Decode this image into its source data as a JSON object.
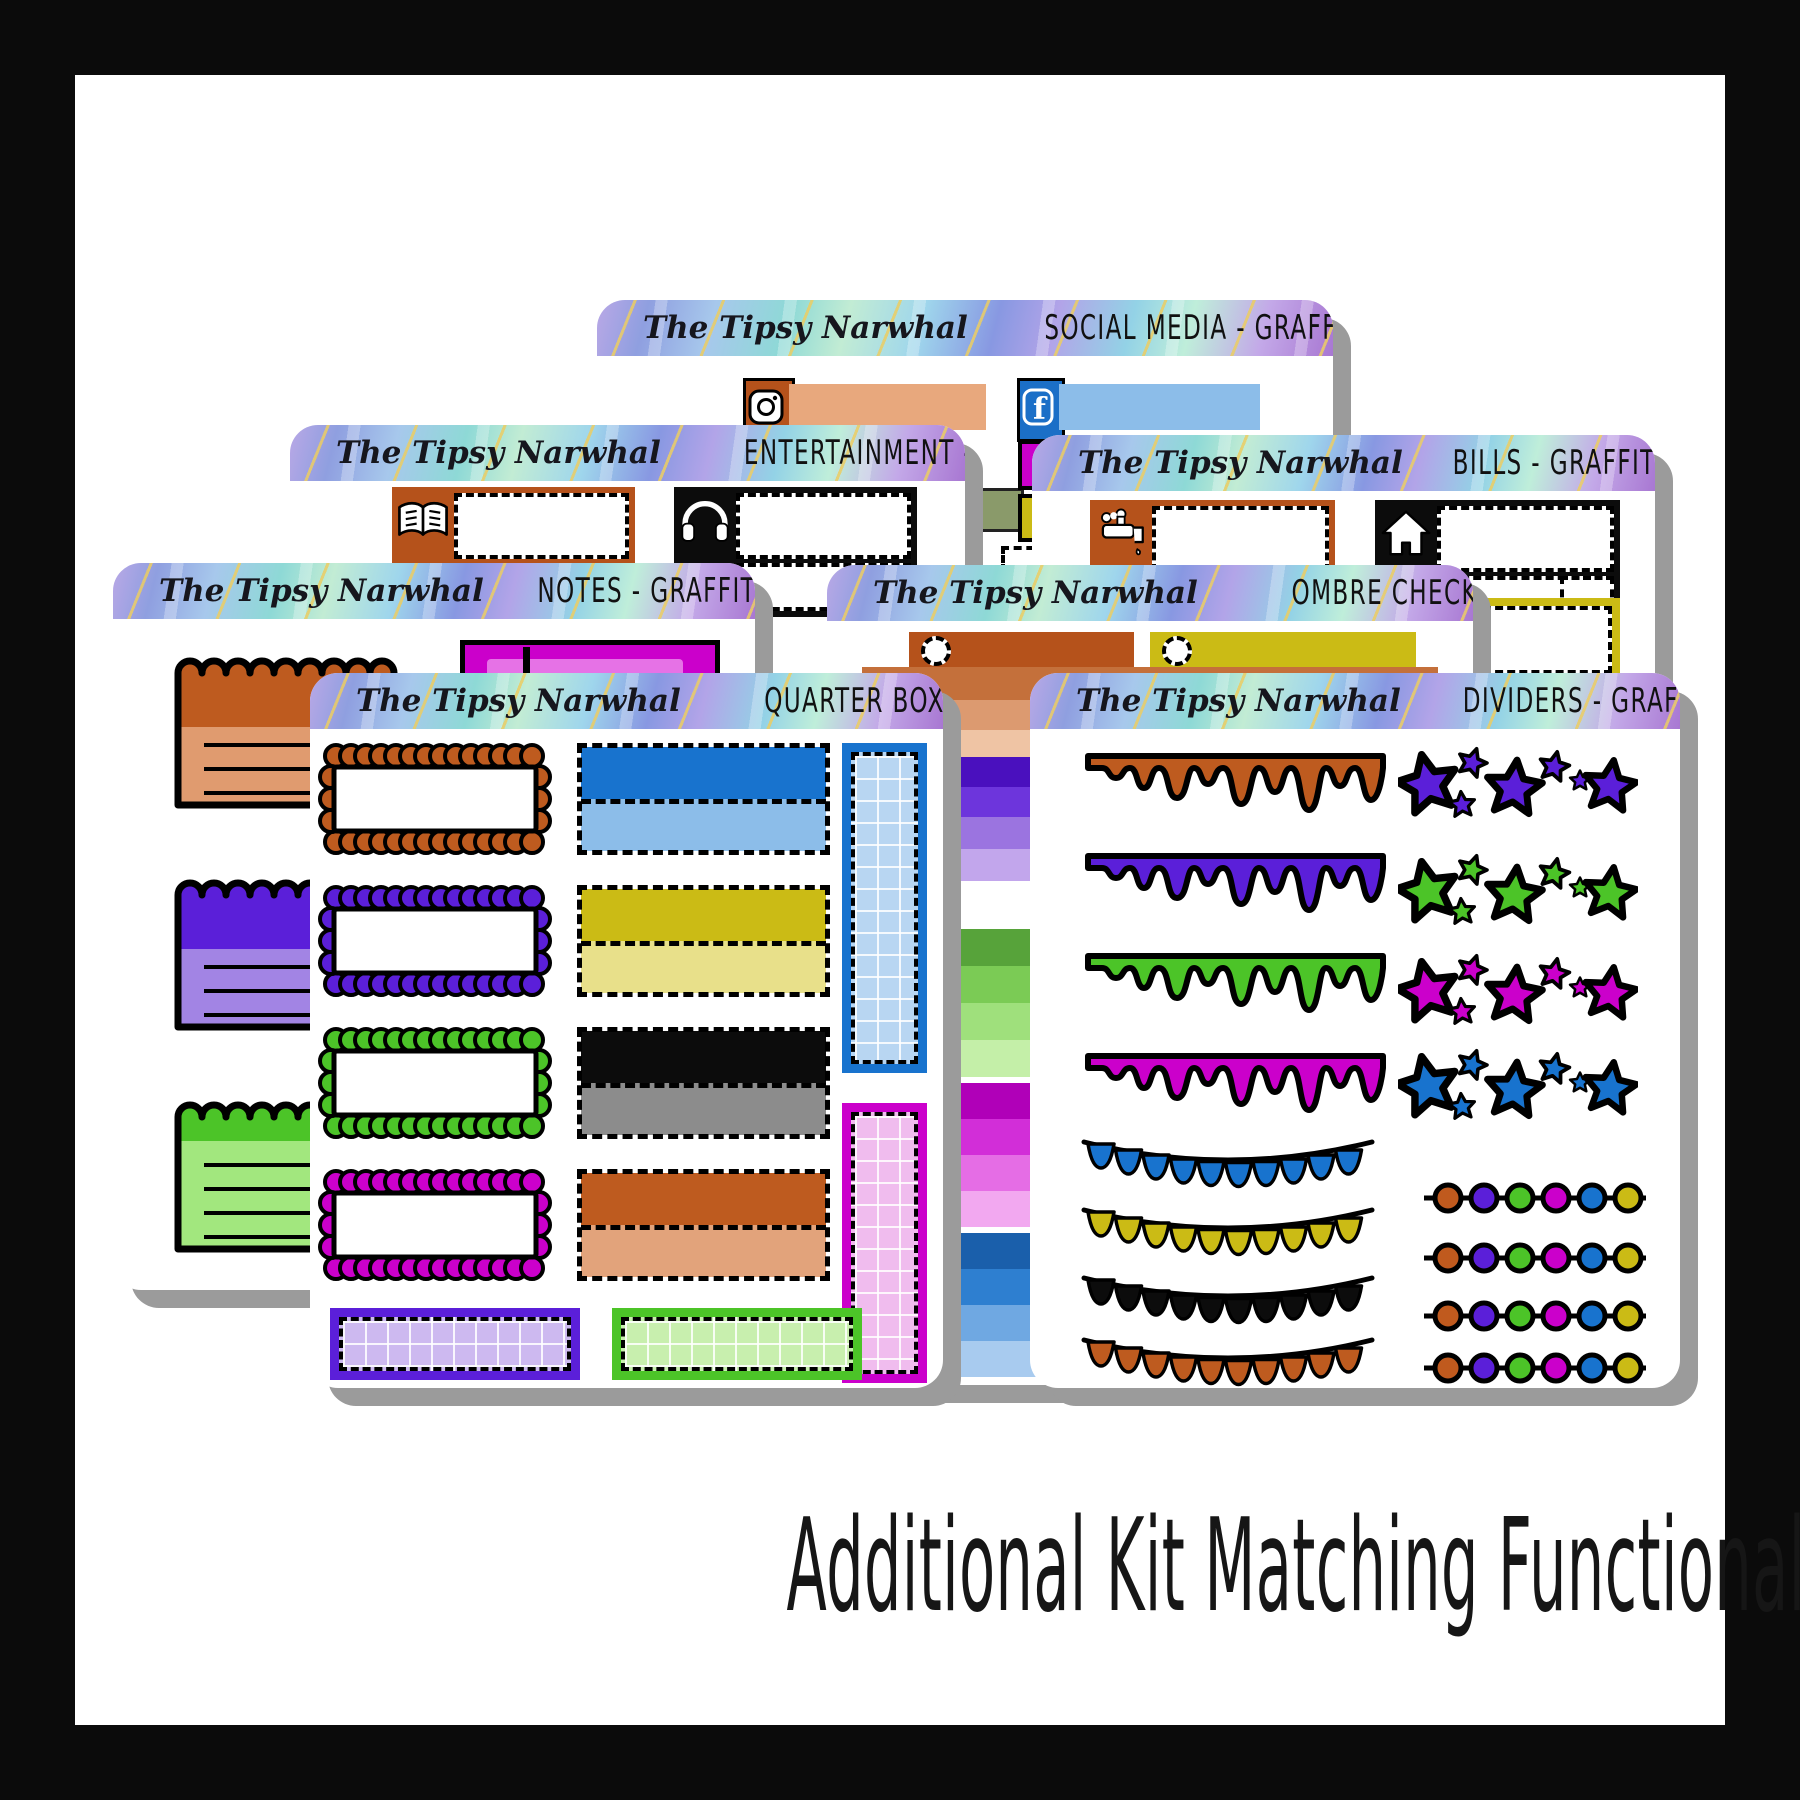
{
  "brand": "The Tipsy Narwhal",
  "caption": "Additional Kit Matching Functionals Available",
  "palette": {
    "rust_orange": "#B5521B",
    "peach": "#E8A87D",
    "blue": "#1873CE",
    "light_blue": "#8CBDE9",
    "magenta": "#CB00CB",
    "light_magenta": "#E672E6",
    "mustard_yellow": "#CBBB15",
    "light_yellow": "#E8E08A",
    "purple": "#5B1FD9",
    "light_purple": "#A284E4",
    "green": "#4CC428",
    "light_green": "#A2E77E",
    "black": "#0C0C0C",
    "gray": "#8C8C8C",
    "sheet_shadow": "#9B9B9B",
    "header_gold_vein": "#E6CD64"
  },
  "sheets": {
    "social_media": {
      "title": "SOCIAL MEDIA - GRAFFITI",
      "stickers": [
        "instagram-label-orange-peach",
        "facebook-label-blue"
      ]
    },
    "entertainment": {
      "title": "ENTERTAINMENT - GRAFFITI",
      "stickers": [
        "book-label-orange",
        "headphones-label-black"
      ]
    },
    "bills": {
      "title": "BILLS - GRAFFITI",
      "stickers": [
        "water-faucet-label-orange",
        "home-label-black",
        "utility-dashed-boxes-yellow"
      ]
    },
    "notes": {
      "title": "NOTES - GRAFFITI",
      "stickers": [
        "torn-note-orange",
        "torn-note-purple",
        "torn-note-green",
        "label-box-magenta"
      ]
    },
    "ombre_checklists": {
      "title": "OMBRE CHECKLISTS - GRAFFITI",
      "stickers": [
        "checklist-bar-orange",
        "checklist-bar-yellow",
        "ombre-strip-orange",
        "ombre-strip-purple",
        "ombre-strip-green",
        "ombre-strip-magenta",
        "ombre-strip-blue"
      ]
    },
    "quarter_boxes": {
      "title": "QUARTER BOXES - GRAFFITI",
      "stickers": [
        "scallop-frame-orange",
        "scallop-frame-purple",
        "scallop-frame-green",
        "scallop-frame-magenta",
        "half-box-blue",
        "half-box-yellow",
        "half-box-black",
        "half-box-orange",
        "grid-column-blue",
        "grid-column-magenta",
        "grid-box-purple",
        "grid-box-green"
      ]
    },
    "dividers": {
      "title": "DIVIDERS - GRAFFITI",
      "stickers": [
        "paint-drip-orange",
        "paint-drip-purple",
        "paint-drip-green",
        "paint-drip-magenta",
        "star-cluster-purple",
        "star-cluster-green",
        "star-cluster-magenta",
        "star-cluster-blue",
        "bunting-blue",
        "bunting-yellow",
        "bunting-black",
        "bunting-orange",
        "bead-string-1",
        "bead-string-2",
        "bead-string-3",
        "bead-string-4"
      ]
    }
  }
}
